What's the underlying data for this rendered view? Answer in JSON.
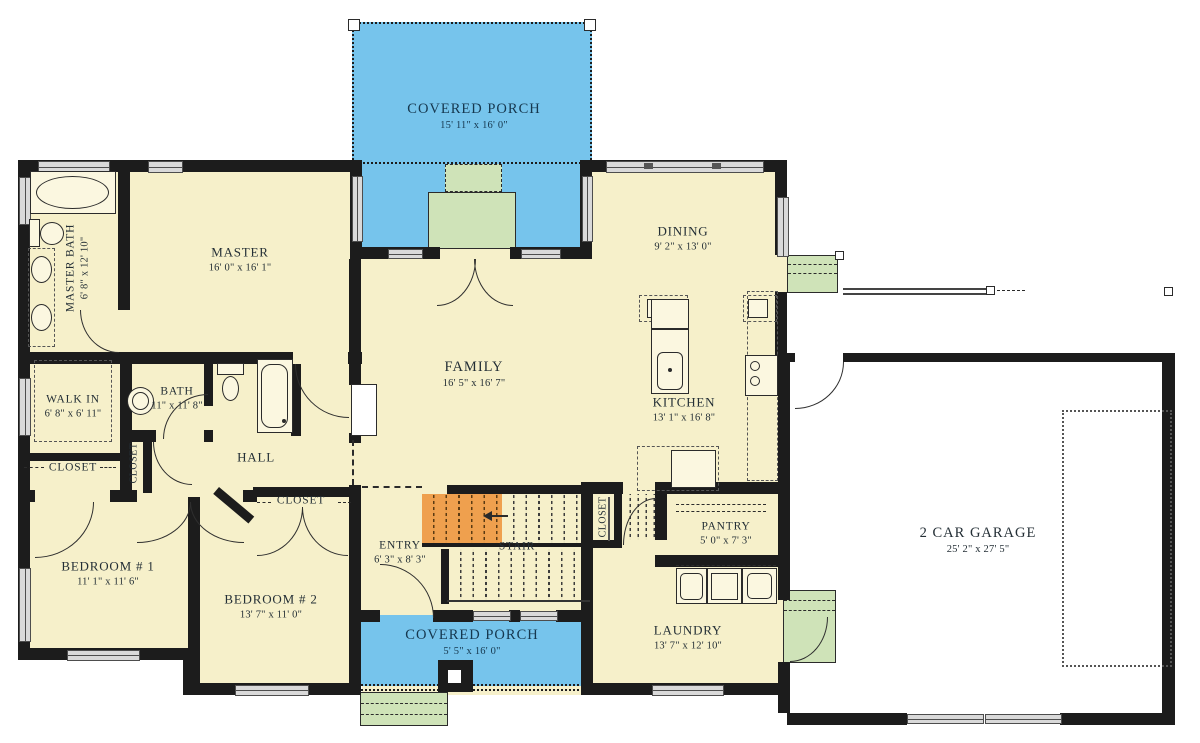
{
  "plan": {
    "type": "floor-plan",
    "rooms": [
      {
        "id": "covered-porch-top",
        "name": "COVERED PORCH",
        "dims": "15' 11\" x 16' 0\""
      },
      {
        "id": "master",
        "name": "MASTER",
        "dims": "16' 0\" x 16' 1\""
      },
      {
        "id": "master-bath",
        "name": "MASTER BATH",
        "dims": "6' 8\" x 12' 10\""
      },
      {
        "id": "walk-in",
        "name": "WALK IN",
        "dims": "6' 8\" x 6' 11\""
      },
      {
        "id": "bath",
        "name": "BATH",
        "dims": "11\" x 11' 8\""
      },
      {
        "id": "closet-hall",
        "name": "CLOSET",
        "dims": ""
      },
      {
        "id": "closet-hall-small",
        "name": "CLOSET",
        "dims": ""
      },
      {
        "id": "hall",
        "name": "HALL",
        "dims": ""
      },
      {
        "id": "bedroom-1",
        "name": "BEDROOM # 1",
        "dims": "11' 1\" x 11' 6\""
      },
      {
        "id": "closet-bedroom-2",
        "name": "CLOSET",
        "dims": ""
      },
      {
        "id": "bedroom-2",
        "name": "BEDROOM # 2",
        "dims": "13' 7\" x 11' 0\""
      },
      {
        "id": "entry",
        "name": "ENTRY",
        "dims": "6' 3\" x 8' 3\""
      },
      {
        "id": "stair",
        "name": "STAIR",
        "dims": ""
      },
      {
        "id": "family",
        "name": "FAMILY",
        "dims": "16' 5\" x 16' 7\""
      },
      {
        "id": "dining",
        "name": "DINING",
        "dims": "9' 2\" x 13' 0\""
      },
      {
        "id": "kitchen",
        "name": "KITCHEN",
        "dims": "13' 1\" x 16' 8\""
      },
      {
        "id": "closet-stair",
        "name": "CLOSET",
        "dims": ""
      },
      {
        "id": "pantry",
        "name": "PANTRY",
        "dims": "5' 0\" x 7' 3\""
      },
      {
        "id": "laundry",
        "name": "LAUNDRY",
        "dims": "13' 7\" x 12' 10\""
      },
      {
        "id": "garage",
        "name": "2 CAR GARAGE",
        "dims": "25' 2\" x 27' 5\""
      },
      {
        "id": "covered-porch-bottom",
        "name": "COVERED PORCH",
        "dims": "5' 5\" x 16' 0\""
      }
    ],
    "colors": {
      "floor": "#f6f0ca",
      "porch": "#76c4ec",
      "steps": "#cfe3b8",
      "stair_highlight": "#efa04e",
      "wall": "#1c1c1c",
      "garage_floor": "#ffffff",
      "label_text": "#242f36",
      "porch_label_text": "#16384f"
    }
  }
}
